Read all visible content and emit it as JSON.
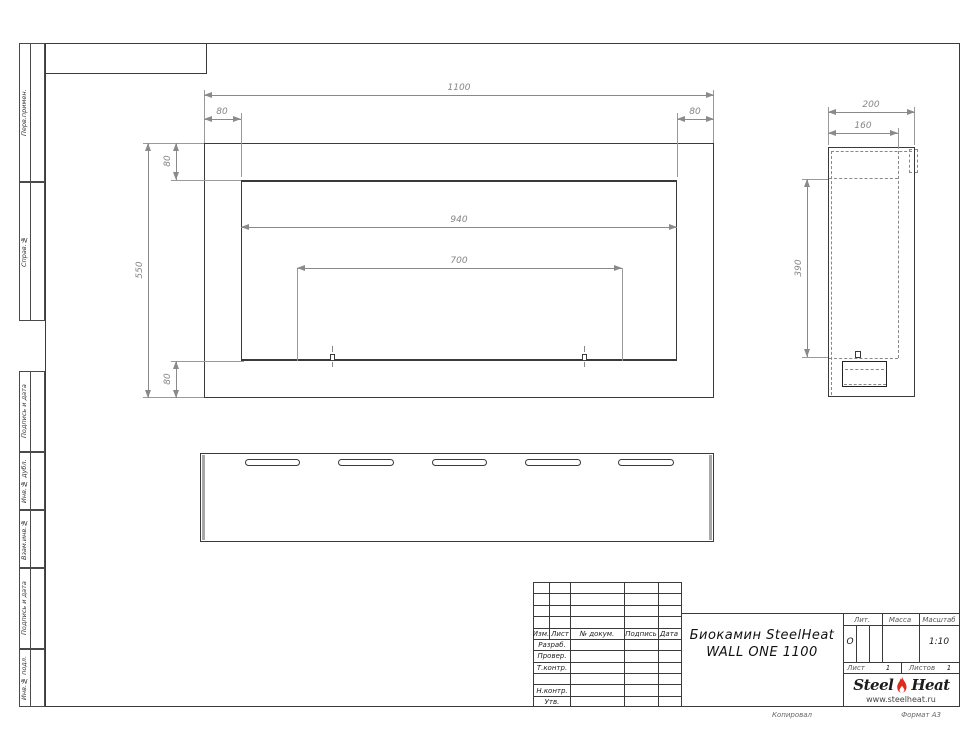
{
  "margin": {
    "items": [
      {
        "label": "Перв.примен."
      },
      {
        "label": "Справ.№"
      },
      {
        "label": "Подпись и дата"
      },
      {
        "label": "Инв.№ дубл."
      },
      {
        "label": "Взам.инв.№"
      },
      {
        "label": "Подпись и дата"
      },
      {
        "label": "Инв.№ подл."
      }
    ]
  },
  "dims": {
    "front": {
      "overall_width": "1100",
      "side_border_left": "80",
      "side_border_right": "80",
      "top_border": "80",
      "opening_width": "940",
      "burner_width": "700",
      "overall_height": "550",
      "bottom_border": "80"
    },
    "side": {
      "depth": "200",
      "inner_depth": "160",
      "opening_height": "390"
    }
  },
  "tb": {
    "rev_header": [
      "Изм.",
      "Лист",
      "№ докум.",
      "Подпись",
      "Дата"
    ],
    "sig_rows": [
      "Разраб.",
      "Провер.",
      "Т.контр.",
      "Н.контр.",
      "Утв."
    ],
    "title1": "Биокамин SteelHeat",
    "title2": "WALL ONE 1100",
    "lit_label": "Лит.",
    "lit_value": "О",
    "mass_label": "Масса",
    "scale_label": "Масштаб",
    "scale_value": "1:10",
    "sheet_label": "Лист",
    "sheet_value": "1",
    "sheets_label": "Листов",
    "sheets_value": "1",
    "logo_steel": "Steel",
    "logo_heat": "Heat",
    "logo_url": "www.steelheat.ru",
    "flame_color": "#df2b1c",
    "flame_inner_color": "#ffffff"
  },
  "footer": {
    "copied": "Копировал",
    "format": "Формат А3"
  }
}
